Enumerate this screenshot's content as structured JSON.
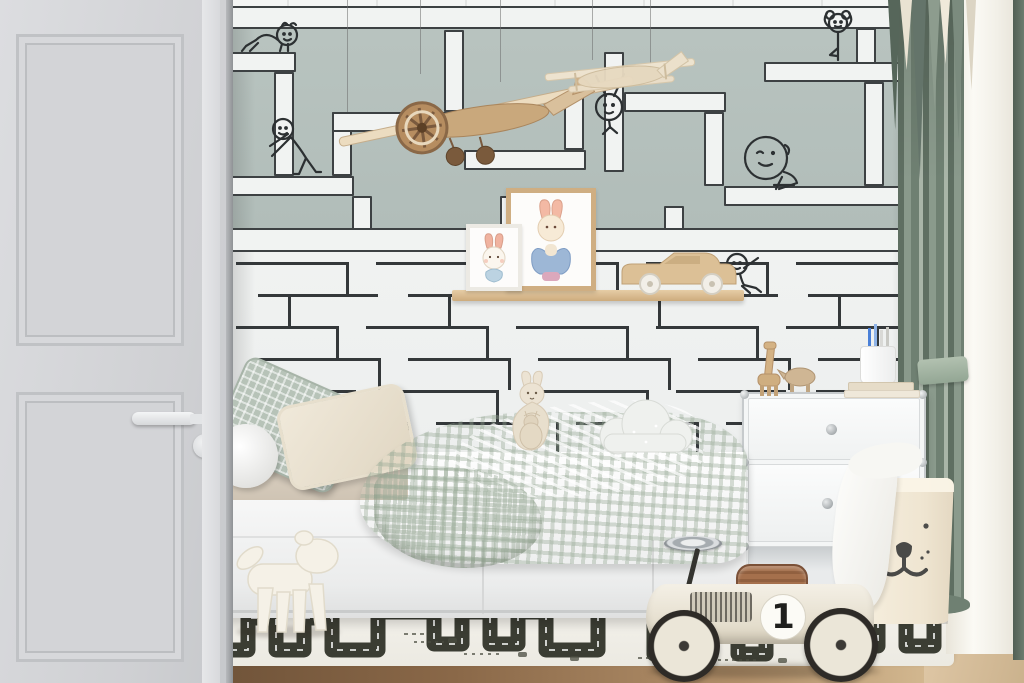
{
  "meta": {
    "scene_label": "Children's bedroom interior with maze-pattern wallpaper, hanging toy airplanes, picture-ledge shelf with bunny art prints, white storage bed, modular white cabinet, bear laundry basket, road-print rug and a vintage ride-on race car"
  },
  "palette": {
    "wall_sage": "#b4bfbb",
    "wall_white": "#eff1f0",
    "maze_corridor": "#f1f3f2",
    "maze_line": "#34383a",
    "door_gray": "#d5d6d9",
    "curtain_green": "#75856f",
    "curtain_sheer": "#f7f4ec",
    "floor_wood": "#dcc5a6",
    "floor_dark_strip": "#7c5e41",
    "rug_white": "#f2f0ea",
    "rug_road": "#3b3d33",
    "toy_wood": "#c9a87c",
    "race_car_body": "#ece7db",
    "race_car_seat": "#9a6a4a",
    "bedding_sage": "#b7c3b8",
    "plush_cream": "#ece3d3"
  },
  "race_car": {
    "number": "1"
  },
  "objects": {
    "doodles": [
      "crawling-baby",
      "pushing-figure",
      "hanging-figure",
      "yoga-figure",
      "big-head-sitting-figure",
      "small-sitting-figure"
    ],
    "wall_items": [
      "toy-airplane-propeller",
      "toy-airplane-light",
      "picture-ledge",
      "small-bunny-print",
      "large-bunny-print",
      "wooden-shelf-car"
    ],
    "furniture": [
      "paneled-door",
      "storage-bed",
      "modular-cabinet",
      "picture-ledge"
    ],
    "toys_floor": [
      "puppy-sculpture",
      "vintage-ride-on-race-car",
      "road-rug"
    ],
    "cabinet_top": [
      "wooden-giraffe",
      "wooden-rhino",
      "pencil-cup",
      "book-stack"
    ],
    "soft_items": [
      "sage-waffle-pillow",
      "cream-pillow",
      "white-bolster",
      "waffle-duvet",
      "kangaroo-plush",
      "cloud-pillow",
      "bear-laundry-basket",
      "white-cloth"
    ],
    "window": [
      "green-drape",
      "sheer-curtain",
      "curtain-tieback"
    ]
  }
}
